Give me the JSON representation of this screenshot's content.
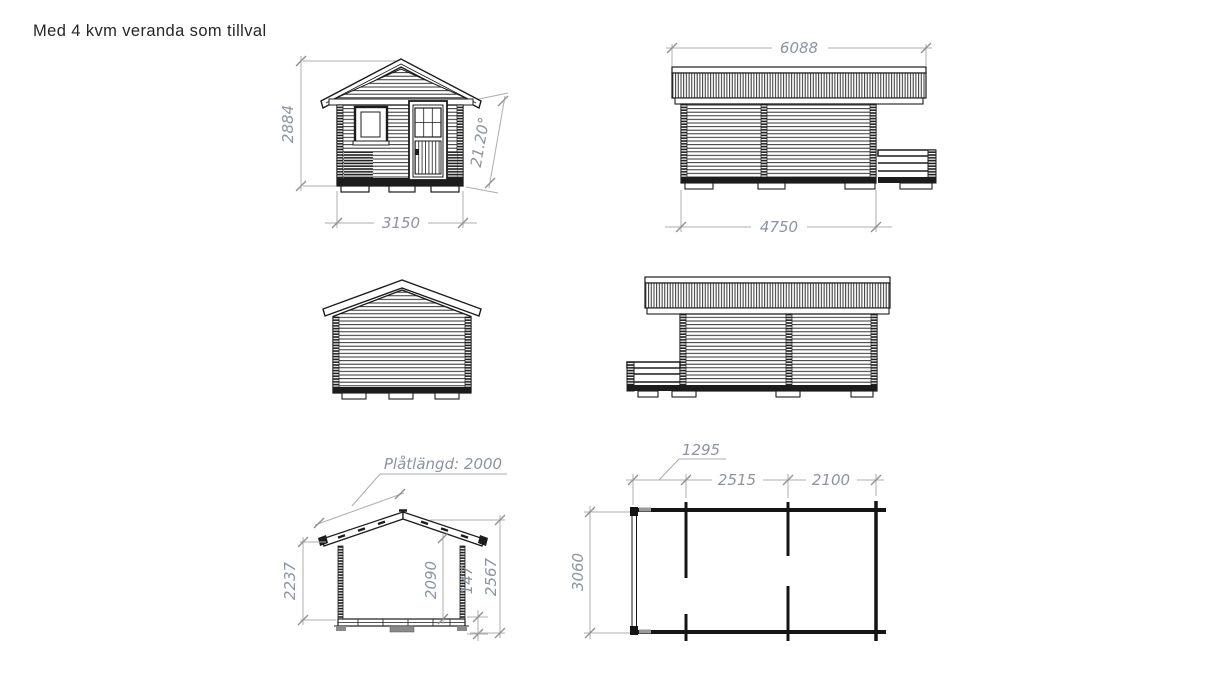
{
  "title": "Med 4 kvm veranda som tillval",
  "views": {
    "front": {
      "label": "Front elevation",
      "height": "2884",
      "width": "3150",
      "roof_angle": "21.20°"
    },
    "side_right": {
      "label": "Side elevation, veranda right",
      "roof_length": "6088",
      "wall_length": "4750"
    },
    "rear": {
      "label": "Rear elevation"
    },
    "side_left": {
      "label": "Side elevation, veranda left"
    },
    "section": {
      "label": "Cross section",
      "sheet_length_label": "Plåtlängd: 2000",
      "eave_height": "2237",
      "interior_height": "2090",
      "floor_height": "147",
      "ridge_height": "2567"
    },
    "plan": {
      "label": "Floor plan",
      "veranda_length": "1295",
      "room_length": "2515",
      "room2_length": "2100",
      "depth": "3060"
    }
  },
  "colors": {
    "drawing_line": "#1c1c1c",
    "dimension_line": "#adadad",
    "dimension_text": "#8a94a4",
    "title_text": "#262626",
    "background": "#ffffff"
  }
}
